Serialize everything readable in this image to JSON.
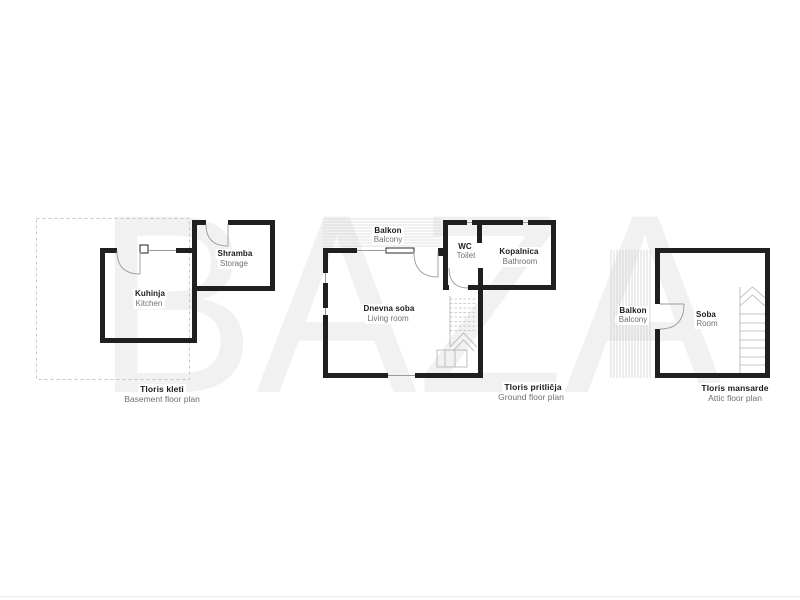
{
  "watermark": "BAZA",
  "colors": {
    "wall": "#1f1f1f",
    "thin_line": "#9a9a9a",
    "hatch": "#d4d4d4",
    "dashed_outline": "#c6c6c6",
    "secondary_text": "#707070",
    "watermark_fill": "#f1f1f1",
    "bottom_rule": "#ececec"
  },
  "plans": [
    {
      "id": "basement",
      "caption": {
        "sl": "Tloris kleti",
        "en": "Basement floor plan"
      },
      "rooms": [
        {
          "sl": "Kuhinja",
          "en": "Kitchen"
        },
        {
          "sl": "Shramba",
          "en": "Storage"
        }
      ]
    },
    {
      "id": "ground",
      "caption": {
        "sl": "Tloris pritličja",
        "en": "Ground floor plan"
      },
      "rooms": [
        {
          "sl": "Balkon",
          "en": "Balcony"
        },
        {
          "sl": "WC",
          "en": "Toilet"
        },
        {
          "sl": "Kopalnica",
          "en": "Bathroom"
        },
        {
          "sl": "Dnevna soba",
          "en": "Living room"
        }
      ]
    },
    {
      "id": "attic",
      "caption": {
        "sl": "Tloris mansarde",
        "en": "Attic floor plan"
      },
      "rooms": [
        {
          "sl": "Balkon",
          "en": "Balcony"
        },
        {
          "sl": "Soba",
          "en": "Room"
        }
      ]
    }
  ]
}
